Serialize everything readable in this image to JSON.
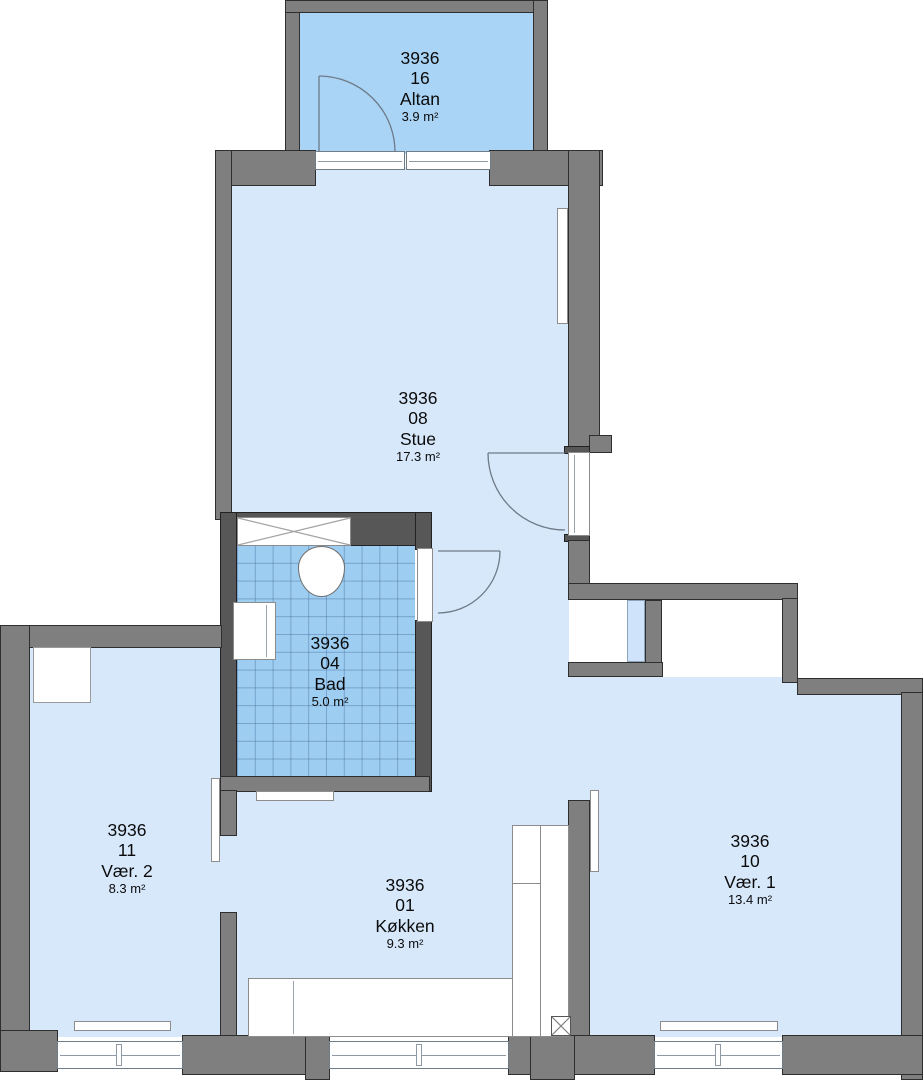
{
  "plan": {
    "building_id": "3936",
    "rooms": [
      {
        "id": "3936",
        "number": "16",
        "name": "Altan",
        "area": "3.9 m²"
      },
      {
        "id": "3936",
        "number": "08",
        "name": "Stue",
        "area": "17.3 m²"
      },
      {
        "id": "3936",
        "number": "04",
        "name": "Bad",
        "area": "5.0 m²"
      },
      {
        "id": "3936",
        "number": "11",
        "name": "Vær. 2",
        "area": "8.3 m²"
      },
      {
        "id": "3936",
        "number": "01",
        "name": "Køkken",
        "area": "9.3 m²"
      },
      {
        "id": "3936",
        "number": "10",
        "name": "Vær. 1",
        "area": "13.4 m²"
      }
    ],
    "colors": {
      "wall": "#7f7f7f",
      "wall_dark": "#575757",
      "wall_outline": "#2e2e2e",
      "room_fill": "#d7e8fb",
      "balcony_fill": "#a9d4f6",
      "bath_fill": "#9ecdf2",
      "fixture_fill": "#ffffff"
    }
  }
}
